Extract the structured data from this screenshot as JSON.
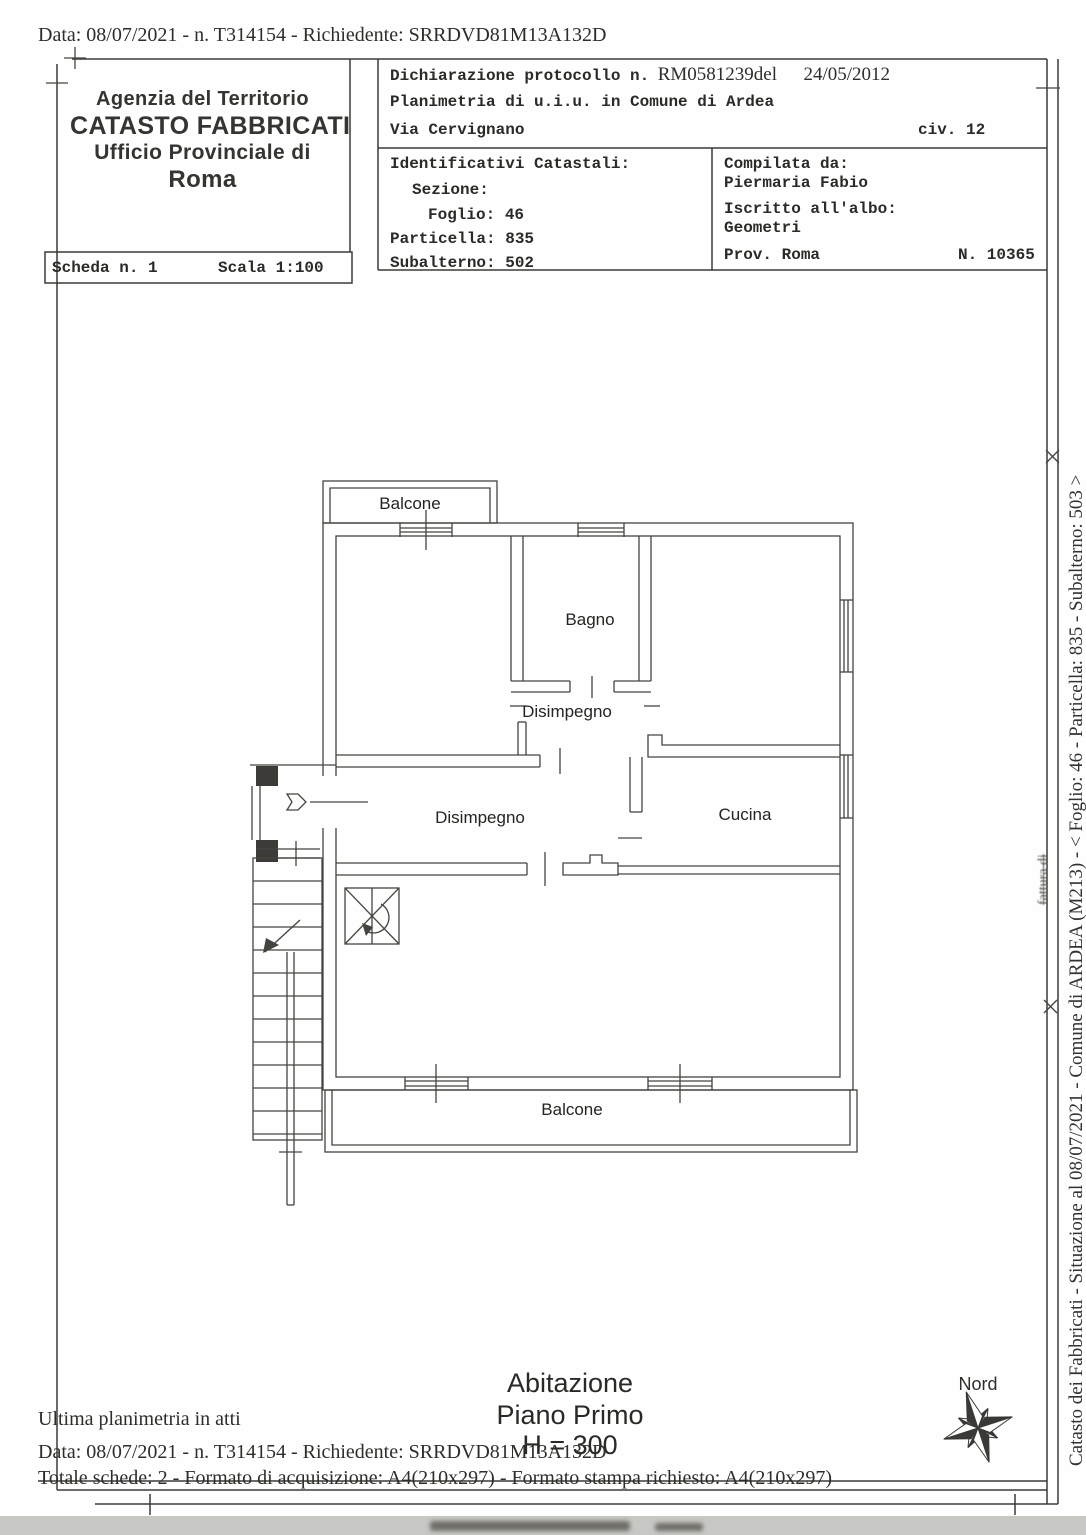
{
  "meta": {
    "top_line": "Data: 08/07/2021 - n. T314154 - Richiedente: SRRDVD81M13A132D"
  },
  "agency": {
    "line1": "Agenzia del Territorio",
    "line2": "CATASTO FABBRICATI",
    "line3": "Ufficio Provinciale di",
    "line4": "Roma"
  },
  "scheda": {
    "number": "Scheda n. 1",
    "scale": "Scala 1:100"
  },
  "declaration": {
    "protocol_label": "Dichiarazione protocollo n.",
    "protocol_value": "RM0581239del",
    "protocol_date": "24/05/2012",
    "planimetria": "Planimetria di u.i.u. in Comune di Ardea",
    "street": "Via Cervignano",
    "civic": "civ. 12"
  },
  "cadastral": {
    "title": "Identificativi Catastali:",
    "sezione": "Sezione:",
    "foglio": "Foglio: 46",
    "particella": "Particella: 835",
    "subalterno": "Subalterno: 502"
  },
  "compiler": {
    "label": "Compilata da:",
    "name": "Piermaria Fabio",
    "albo_label": "Iscritto all'albo:",
    "albo": "Geometri",
    "prov": "Prov. Roma",
    "number": "N. 10365"
  },
  "plan": {
    "balcone_top": "Balcone",
    "bagno": "Bagno",
    "disimpegno_top": "Disimpegno",
    "disimpegno_low": "Disimpegno",
    "cucina": "Cucina",
    "balcone_bottom": "Balcone"
  },
  "caption": {
    "line1": "Abitazione",
    "line2": "Piano Primo",
    "line3": "H = 300"
  },
  "compass": {
    "label": "Nord"
  },
  "sidebar": {
    "text": "Catasto dei Fabbricati - Situazione al 08/07/2021 - Comune di ARDEA (M213) - <  Foglio: 46 - Particella: 835 - Subalterno: 503 >",
    "artifact": "fattura di"
  },
  "footer": {
    "line1": "Ultima planimetria in atti",
    "line2": "Data: 08/07/2021 - n. T314154 - Richiedente: SRRDVD81M13A132D",
    "line3": "Totale schede: 2 - Formato di acquisizione: A4(210x297)  - Formato stampa richiesto: A4(210x297)"
  }
}
